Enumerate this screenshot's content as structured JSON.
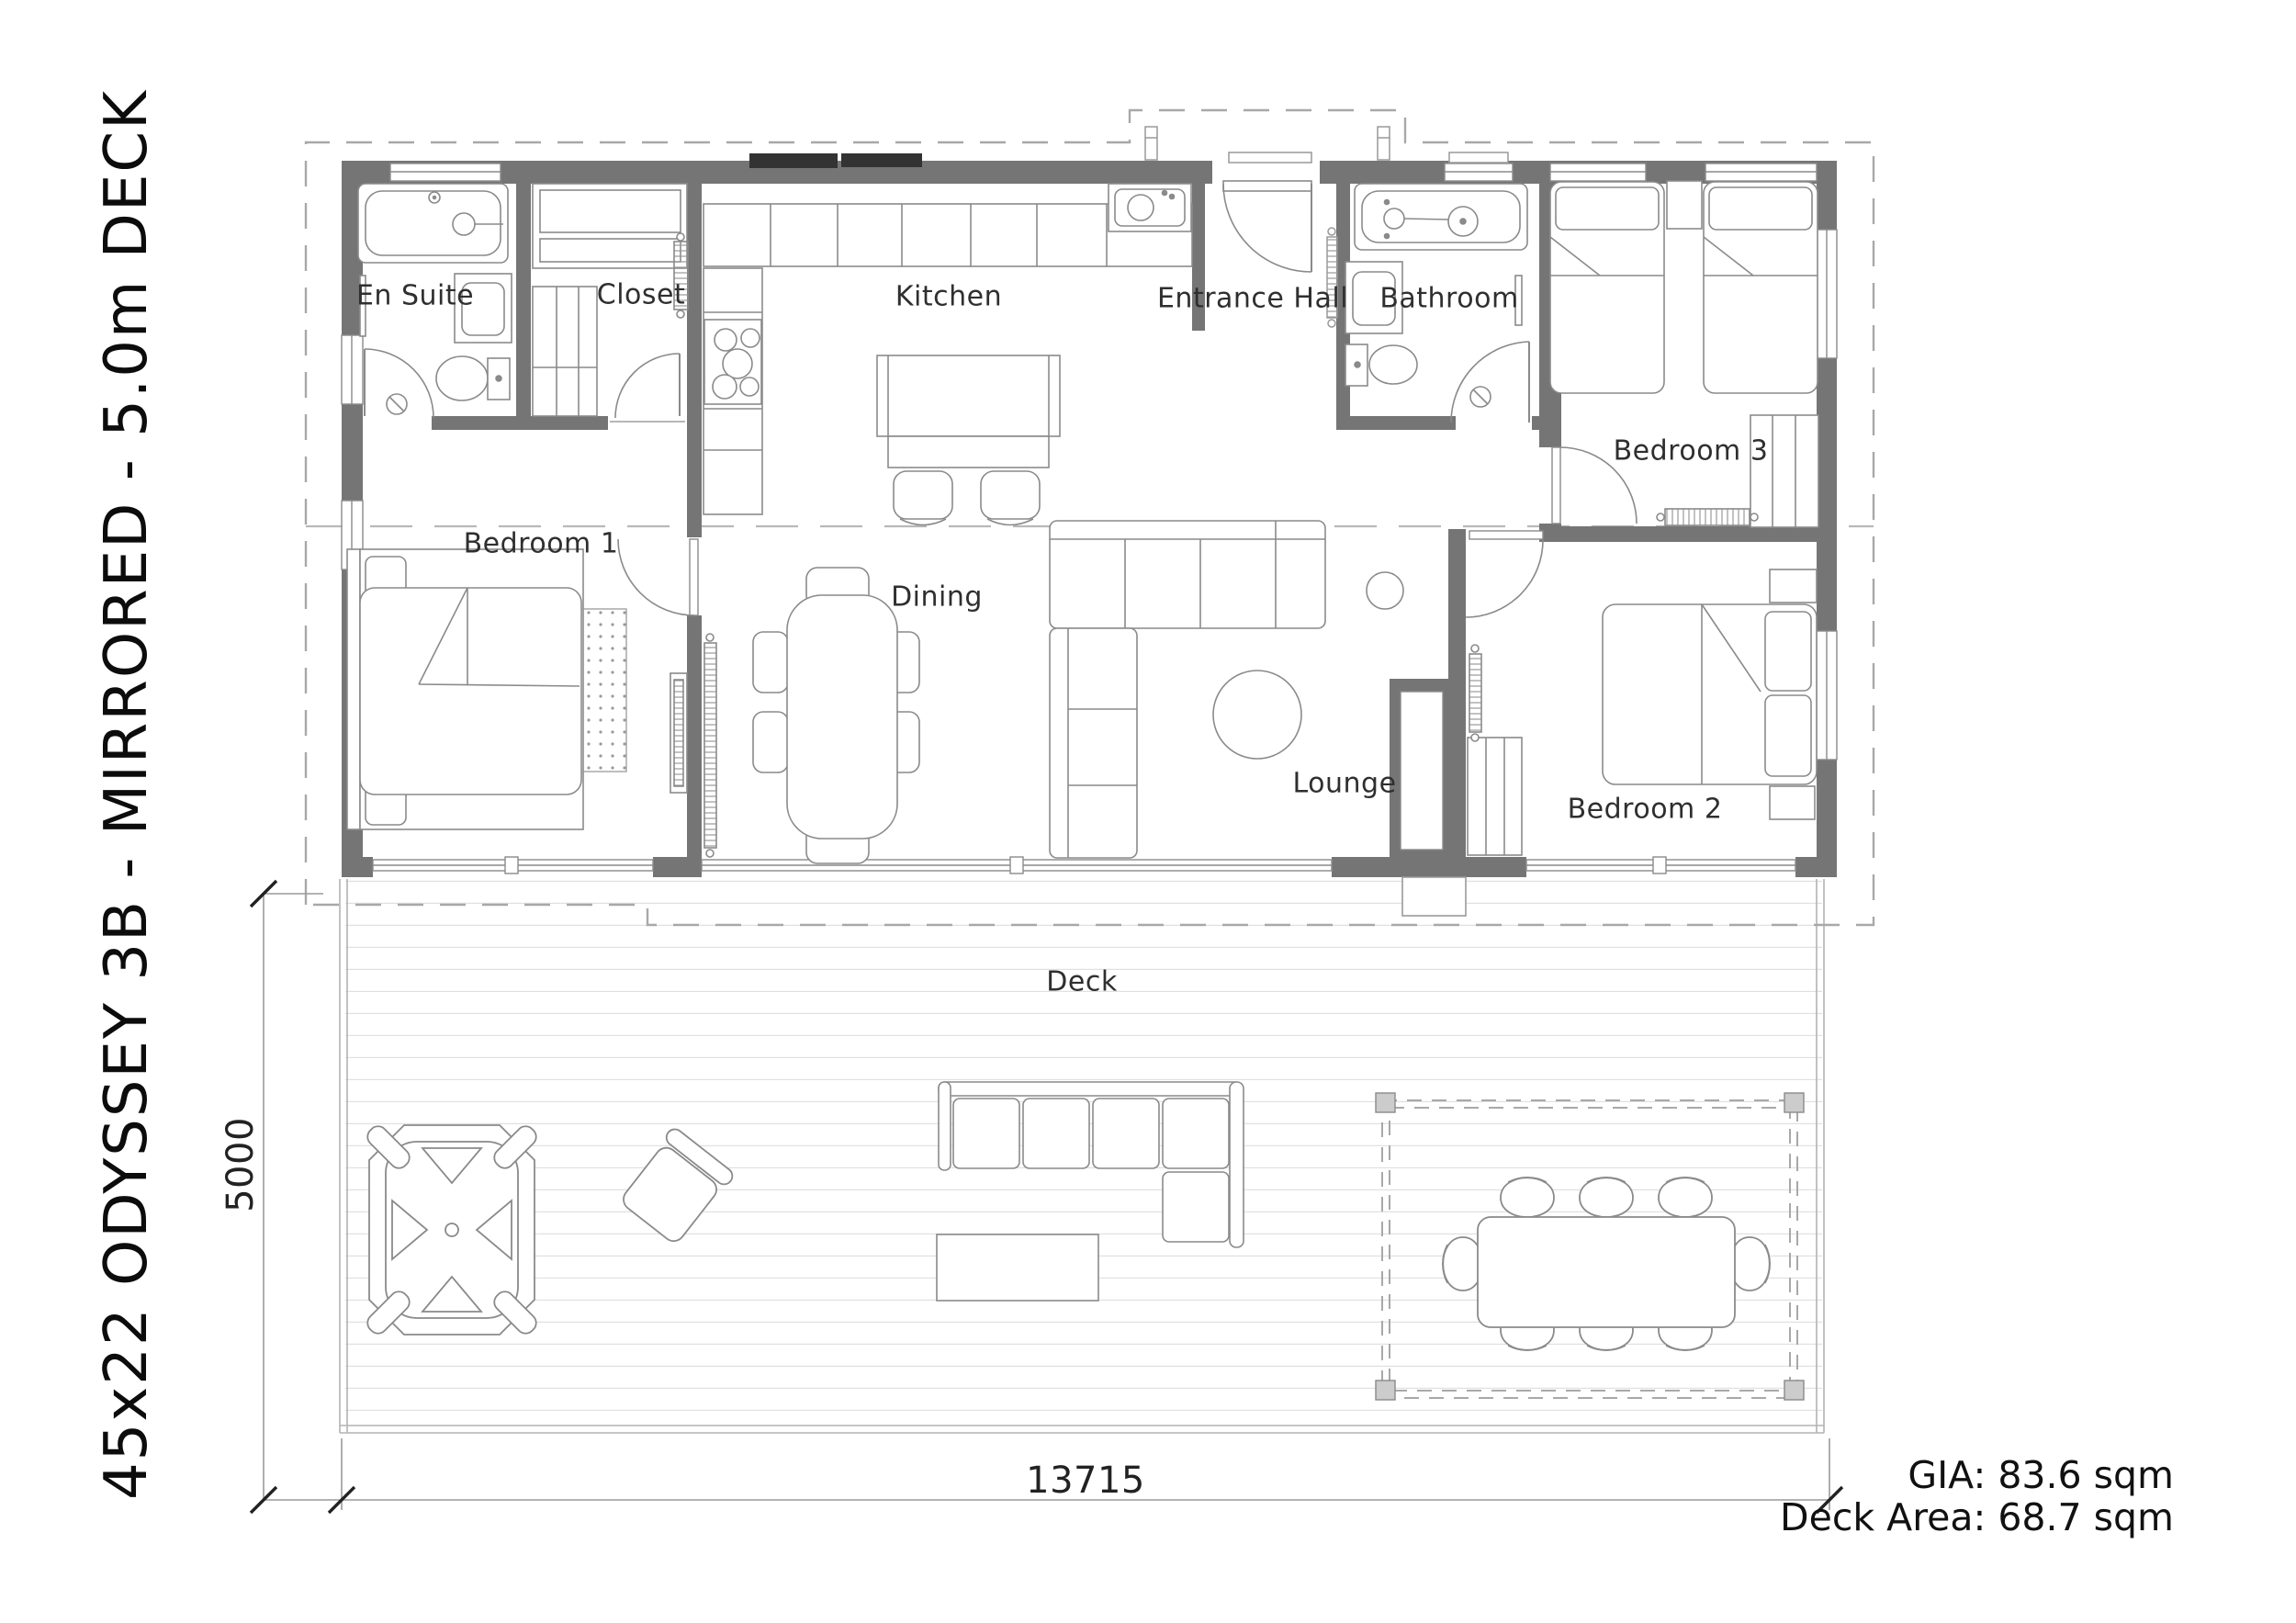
{
  "drawing_title": "45x22 ODYSSEY 3B - MIRRORED - 5.0m DECK",
  "rooms": {
    "en_suite": "En Suite",
    "closet": "Closet",
    "kitchen": "Kitchen",
    "entrance_hall": "Entrance Hall",
    "bathroom": "Bathroom",
    "bedroom_1": "Bedroom 1",
    "bedroom_2": "Bedroom 2",
    "bedroom_3": "Bedroom 3",
    "dining": "Dining",
    "lounge": "Lounge",
    "deck": "Deck"
  },
  "dimensions": {
    "deck_width_mm": "13715",
    "deck_depth_mm": "5000"
  },
  "areas": {
    "gia": "GIA: 83.6 sqm",
    "deck_area": "Deck Area: 68.7 sqm"
  },
  "colors": {
    "wall": "#757575",
    "furniture_line": "#8a8a8a",
    "dashed_line": "#a8a8a8",
    "deck_plank": "#e0e0e0",
    "text": "#2a2a2a",
    "window_band": "#333333"
  }
}
